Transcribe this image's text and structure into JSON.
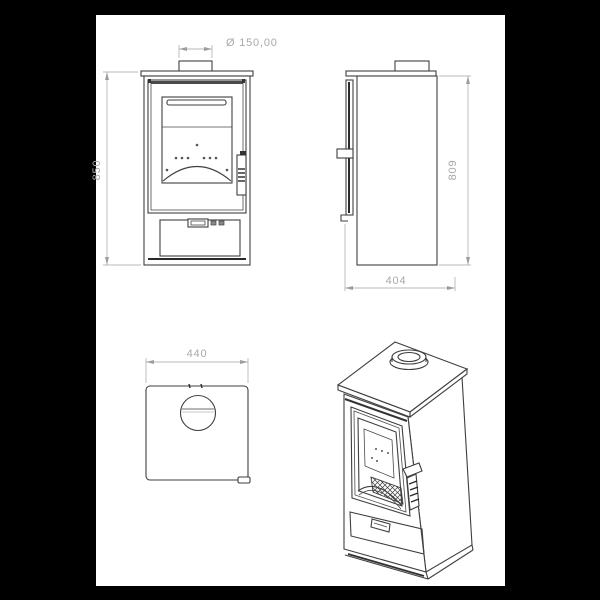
{
  "drawing": {
    "type": "technical-drawing",
    "subject": "wood burning stove, multi-view dimensioned drawing",
    "colors": {
      "background": "#000000",
      "paper": "#ffffff",
      "line": "#3f3f3f",
      "dimension": "#a8a8a8"
    },
    "views": {
      "front": {
        "name": "front view",
        "height": "850",
        "flue_diameter": "Ø 150,00"
      },
      "side": {
        "name": "side view",
        "height": "809",
        "depth": "404"
      },
      "top": {
        "name": "top view",
        "width": "440"
      },
      "perspective": {
        "name": "perspective view"
      }
    }
  }
}
